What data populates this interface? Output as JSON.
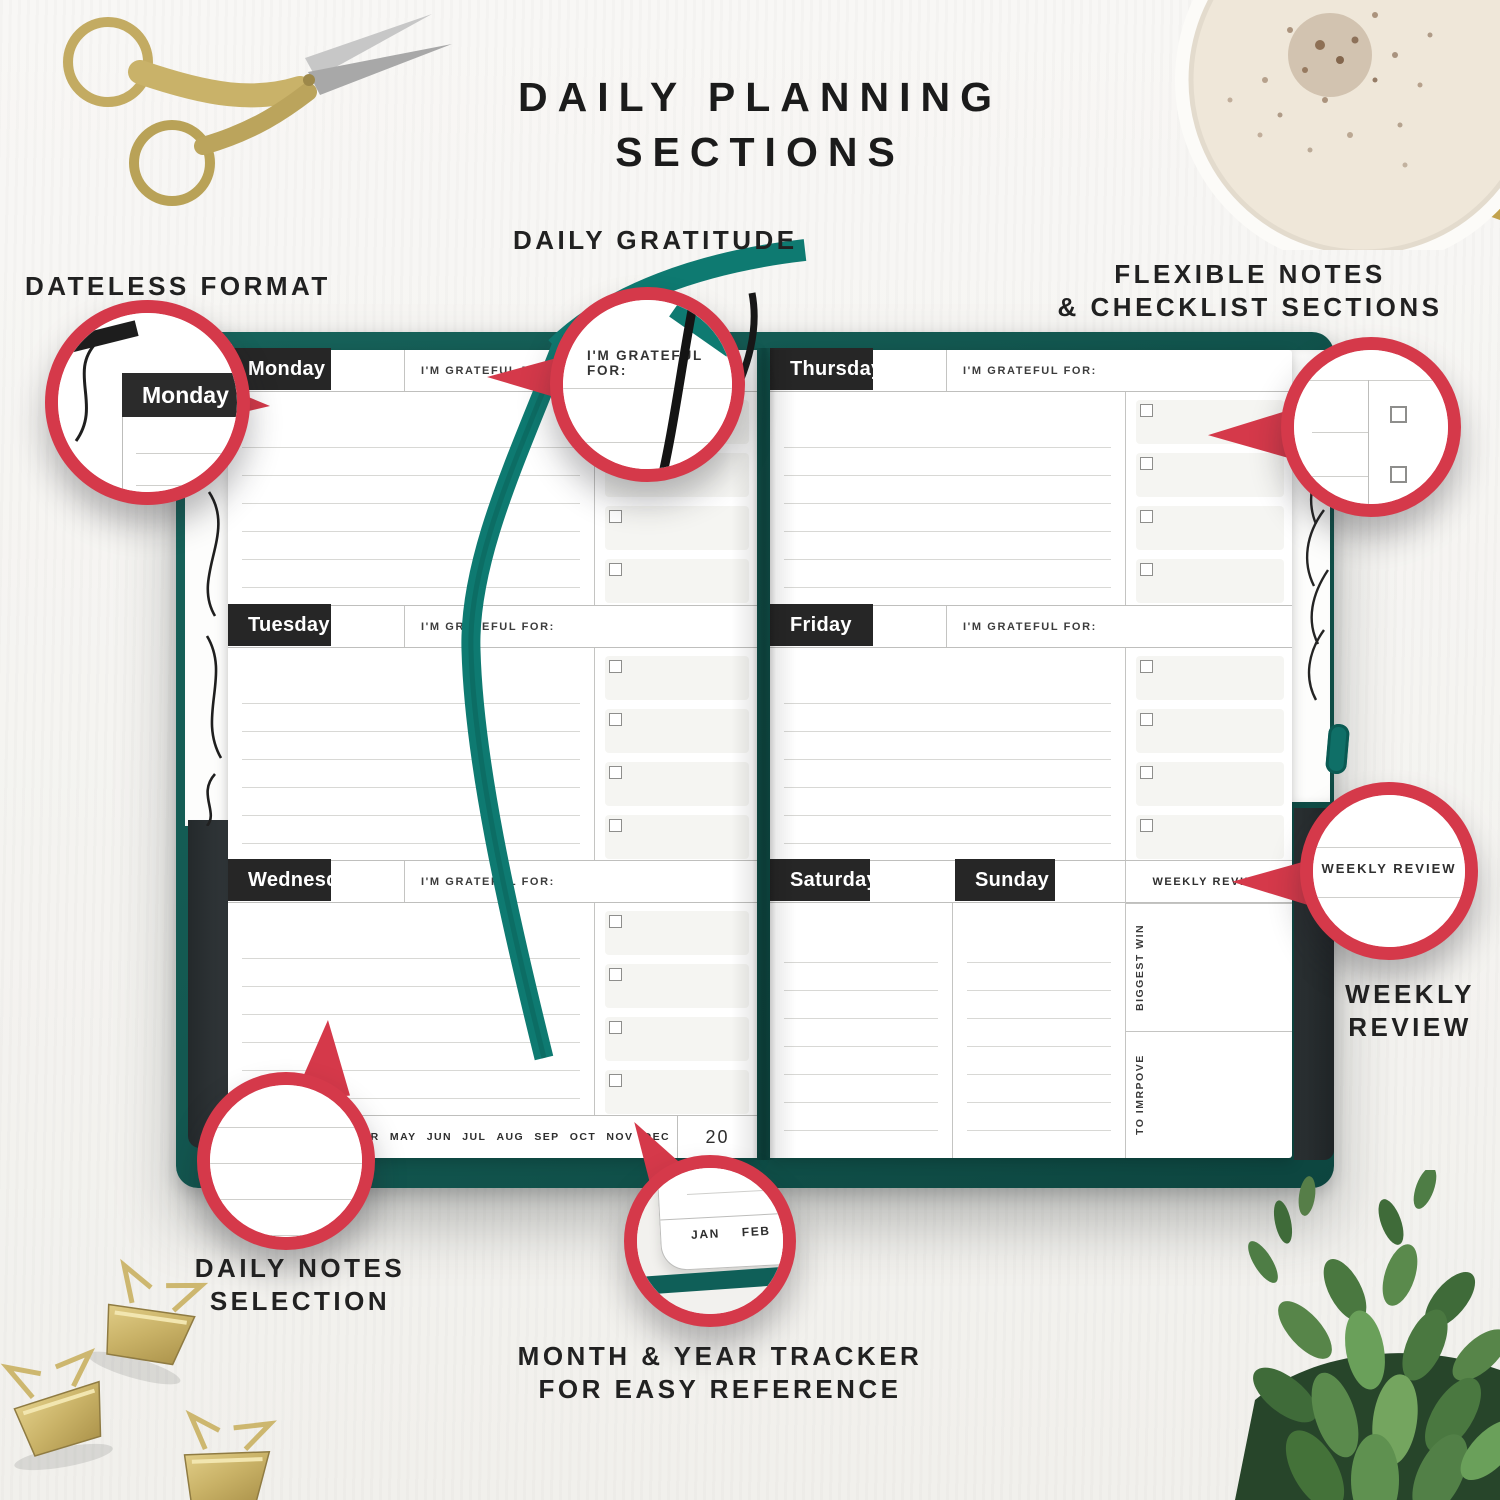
{
  "title": {
    "line1": "DAILY PLANNING",
    "line2": "SECTIONS"
  },
  "callouts": {
    "dateless_format": {
      "label": "DATELESS FORMAT"
    },
    "daily_gratitude": {
      "label": "DAILY GRATITUDE"
    },
    "flexible_notes": {
      "line1": "FLEXIBLE NOTES",
      "line2": "& CHECKLIST SECTIONS"
    },
    "weekly_review": {
      "line1": "WEEKLY",
      "line2": "REVIEW"
    },
    "daily_notes": {
      "line1": "DAILY NOTES",
      "line2": "SELECTION"
    },
    "month_year_tracker": {
      "line1": "MONTH & YEAR TRACKER",
      "line2": "FOR EASY REFERENCE"
    }
  },
  "planner": {
    "days": {
      "monday": "Monday",
      "tuesday": "Tuesday",
      "wednesday": "Wednesday",
      "thursday": "Thursday",
      "friday": "Friday",
      "saturday": "Saturday",
      "sunday": "Sunday"
    },
    "grateful_label": "I'M GRATEFUL FOR:",
    "weekly_review_header": "WEEKLY REVIEW",
    "biggest_win": "BIGGEST WIN",
    "to_improve": "TO IMRPOVE",
    "months": [
      "JAN",
      "FEB",
      "MAR",
      "APR",
      "MAY",
      "JUN",
      "JUL",
      "AUG",
      "SEP",
      "OCT",
      "NOV",
      "DEC"
    ],
    "year": "20"
  },
  "magnifiers": {
    "monday": "Monday",
    "grateful": "I'M GRATEFUL FOR:",
    "weekly": "WEEKLY REVIEW",
    "win": "WIN",
    "months_zoom": [
      "JAN",
      "FEB",
      "MAR",
      "A"
    ]
  },
  "colors": {
    "accent_red": "#d5394a",
    "cover_teal": "#11534c",
    "ribbon_teal": "#0e7a71",
    "header_black": "#262626"
  }
}
